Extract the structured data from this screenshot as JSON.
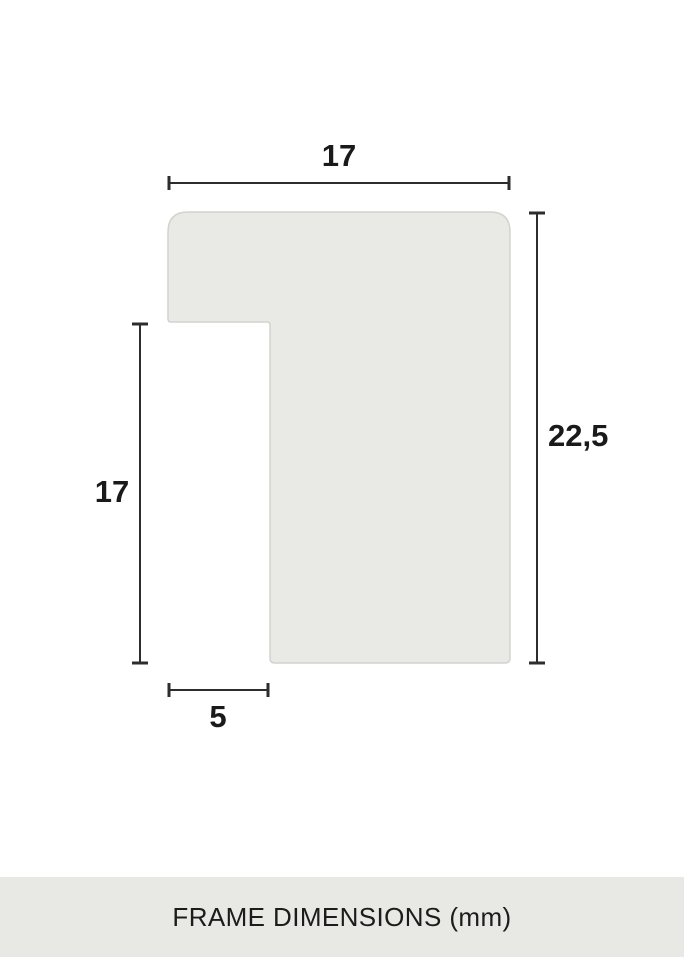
{
  "diagram": {
    "caption": "FRAME DIMENSIONS (mm)",
    "unit": "mm",
    "dimensions": {
      "top_width": "17",
      "right_height": "22,5",
      "left_height": "17",
      "bottom_width": "5"
    },
    "colors": {
      "background": "#ffffff",
      "profile_fill": "#e9e9e5",
      "profile_border": "#d2d2ce",
      "dimension_line": "#2d2d2d",
      "label_text": "#1a1a1a",
      "footer_background": "#e8e8e4",
      "footer_text": "#1c1c1c"
    }
  }
}
